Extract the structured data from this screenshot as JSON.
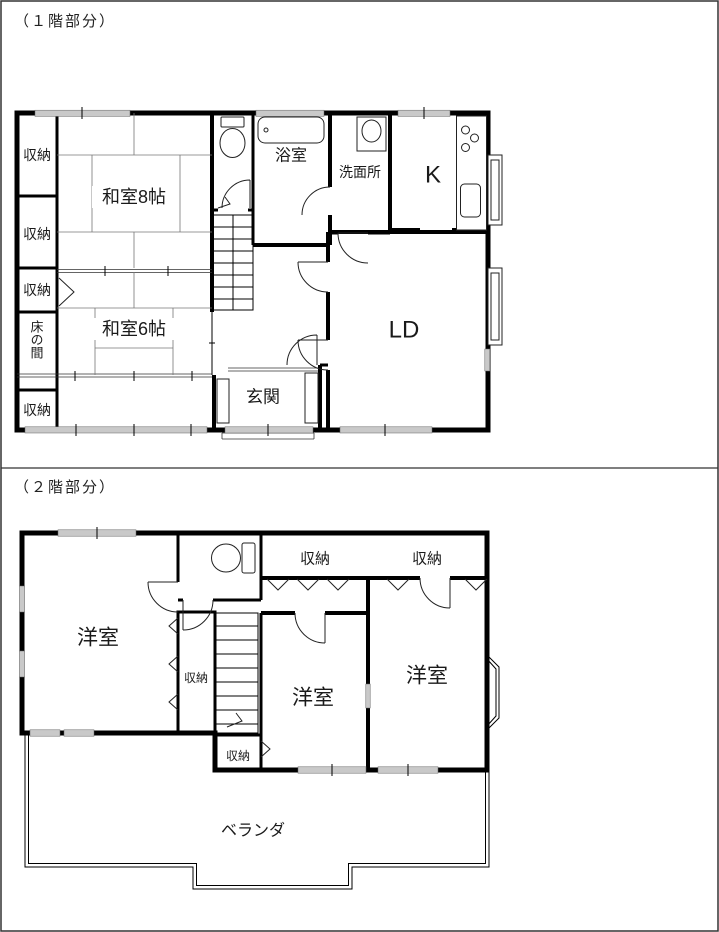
{
  "floor1": {
    "title": "（１階部分）",
    "labels": {
      "closet": "収納",
      "washitsu8": "和室8帖",
      "washitsu6": "和室6帖",
      "tokonoma": "床の間",
      "bath": "浴室",
      "washroom": "洗面所",
      "kitchen": "K",
      "living_dining": "LD",
      "entrance": "玄関"
    }
  },
  "floor2": {
    "title": "（２階部分）",
    "labels": {
      "western_room": "洋室",
      "closet": "収納",
      "veranda": "ベランダ"
    }
  },
  "colors": {
    "wall": "#000000",
    "window_fill": "#c9c9c9",
    "background": "#ffffff"
  }
}
